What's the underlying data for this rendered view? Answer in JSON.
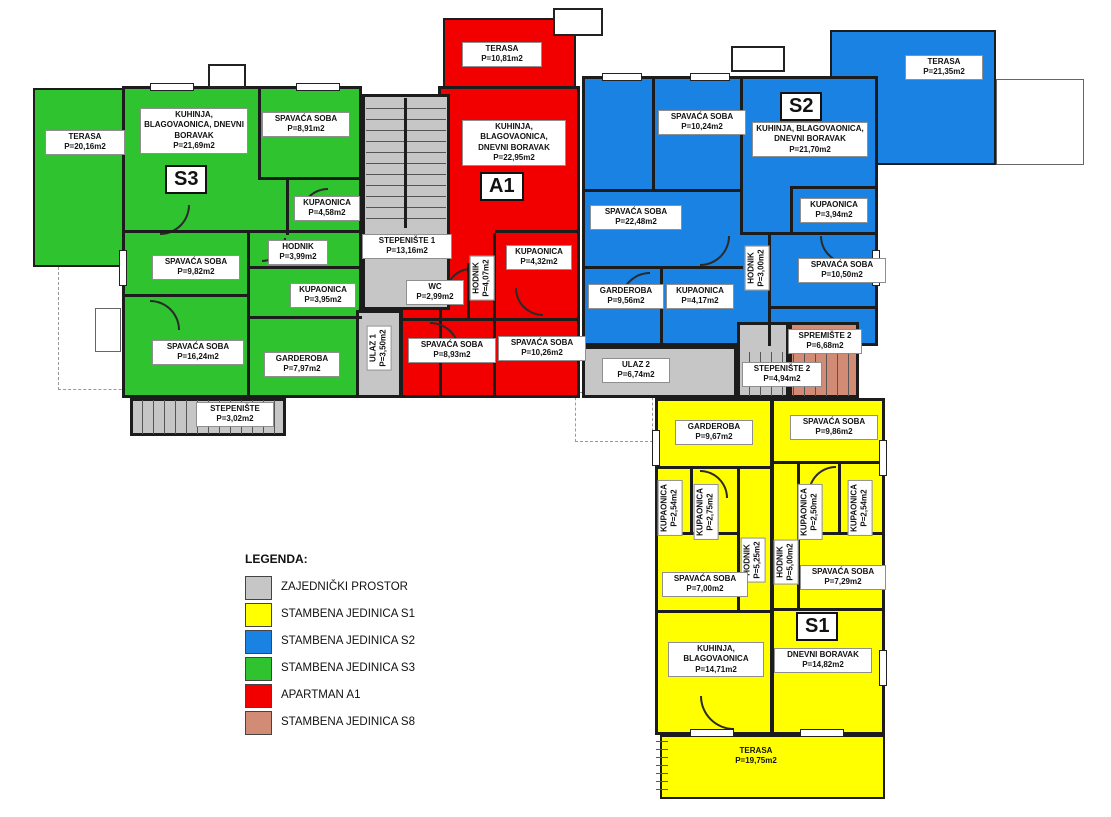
{
  "colors": {
    "common": "#c6c6c6",
    "s1": "#ffff00",
    "s2": "#1a82e2",
    "s3": "#2fc32f",
    "a1": "#f20000",
    "s8": "#d28c76",
    "wall": "#1c1c1c"
  },
  "legend": {
    "title": "LEGENDA:",
    "items": [
      {
        "label": "ZAJEDNIČKI PROSTOR",
        "color": "#c6c6c6"
      },
      {
        "label": "STAMBENA JEDINICA  S1",
        "color": "#ffff00"
      },
      {
        "label": "STAMBENA JEDINICA  S2",
        "color": "#1a82e2"
      },
      {
        "label": "STAMBENA JEDINICA  S3",
        "color": "#2fc32f"
      },
      {
        "label": "APARTMAN A1",
        "color": "#f20000"
      },
      {
        "label": "STAMBENA JEDINICA  S8",
        "color": "#d28c76"
      }
    ]
  },
  "units": {
    "s3": {
      "badge": "S3",
      "color": "#2fc32f",
      "rooms": [
        {
          "name": "TERASA",
          "area": "P=20,16m2"
        },
        {
          "name": "KUHINJA, BLAGOVAONICA, DNEVNI BORAVAK",
          "area": "P=21,69m2"
        },
        {
          "name": "SPAVAĆA SOBA",
          "area": "P=8,91m2"
        },
        {
          "name": "KUPAONICA",
          "area": "P=4,58m2"
        },
        {
          "name": "HODNIK",
          "area": "P=3,99m2"
        },
        {
          "name": "SPAVAĆA SOBA",
          "area": "P=9,82m2"
        },
        {
          "name": "KUPAONICA",
          "area": "P=3,95m2"
        },
        {
          "name": "SPAVAĆA SOBA",
          "area": "P=16,24m2"
        },
        {
          "name": "GARDEROBA",
          "area": "P=7,97m2"
        },
        {
          "name": "STEPENIŠTE",
          "area": "P=3,02m2"
        }
      ]
    },
    "a1": {
      "badge": "A1",
      "color": "#f20000",
      "rooms": [
        {
          "name": "TERASA",
          "area": "P=10,81m2"
        },
        {
          "name": "KUHINJA, BLAGOVAONICA, DNEVNI BORAVAK",
          "area": "P=22,95m2"
        },
        {
          "name": "KUPAONICA",
          "area": "P=4,32m2"
        },
        {
          "name": "WC",
          "area": "P=2,99m2"
        },
        {
          "name": "HODNIK",
          "area": "P=4,07m2"
        },
        {
          "name": "SPAVAĆA SOBA",
          "area": "P=8,93m2"
        },
        {
          "name": "SPAVAĆA SOBA",
          "area": "P=10,26m2"
        }
      ]
    },
    "s2": {
      "badge": "S2",
      "color": "#1a82e2",
      "rooms": [
        {
          "name": "TERASA",
          "area": "P=21,35m2"
        },
        {
          "name": "SPAVAĆA SOBA",
          "area": "P=10,24m2"
        },
        {
          "name": "KUHINJA, BLAGOVAONICA, DNEVNI BORAVAK",
          "area": "P=21,70m2"
        },
        {
          "name": "KUPAONICA",
          "area": "P=3,94m2"
        },
        {
          "name": "SPAVAĆA SOBA",
          "area": "P=22,48m2"
        },
        {
          "name": "HODNIK",
          "area": "P=3,00m2"
        },
        {
          "name": "SPAVAĆA SOBA",
          "area": "P=10,50m2"
        },
        {
          "name": "GARDEROBA",
          "area": "P=9,56m2"
        },
        {
          "name": "KUPAONICA",
          "area": "P=4,17m2"
        }
      ]
    },
    "s1": {
      "badge": "S1",
      "color": "#ffff00",
      "rooms": [
        {
          "name": "GARDEROBA",
          "area": "P=9,67m2"
        },
        {
          "name": "SPAVAĆA SOBA",
          "area": "P=9,86m2"
        },
        {
          "name": "KUPAONICA",
          "area": "P=2,54m2"
        },
        {
          "name": "KUPAONICA",
          "area": "P=2,75m2"
        },
        {
          "name": "KUPAONICA",
          "area": "P=2,50m2"
        },
        {
          "name": "KUPAONICA",
          "area": "P=2,54m2"
        },
        {
          "name": "HODNIK",
          "area": "P=5,25m2"
        },
        {
          "name": "HODNIK",
          "area": "P=5,00m2"
        },
        {
          "name": "SPAVAĆA SOBA",
          "area": "P=7,00m2"
        },
        {
          "name": "SPAVAĆA SOBA",
          "area": "P=7,29m2"
        },
        {
          "name": "KUHINJA, BLAGOVAONICA",
          "area": "P=14,71m2"
        },
        {
          "name": "DNEVNI BORAVAK",
          "area": "P=14,82m2"
        },
        {
          "name": "TERASA",
          "area": "P=19,75m2"
        }
      ]
    },
    "common": {
      "color": "#c6c6c6",
      "rooms": [
        {
          "name": "STEPENIŠTE 1",
          "area": "P=13,16m2"
        },
        {
          "name": "ULAZ 1",
          "area": "P=3,50m2"
        },
        {
          "name": "ULAZ 2",
          "area": "P=6,74m2"
        },
        {
          "name": "STEPENIŠTE 2",
          "area": "P=4,94m2"
        }
      ]
    },
    "s8": {
      "color": "#d28c76",
      "rooms": [
        {
          "name": "SPREMIŠTE 2",
          "area": "P=6,68m2"
        }
      ]
    }
  }
}
